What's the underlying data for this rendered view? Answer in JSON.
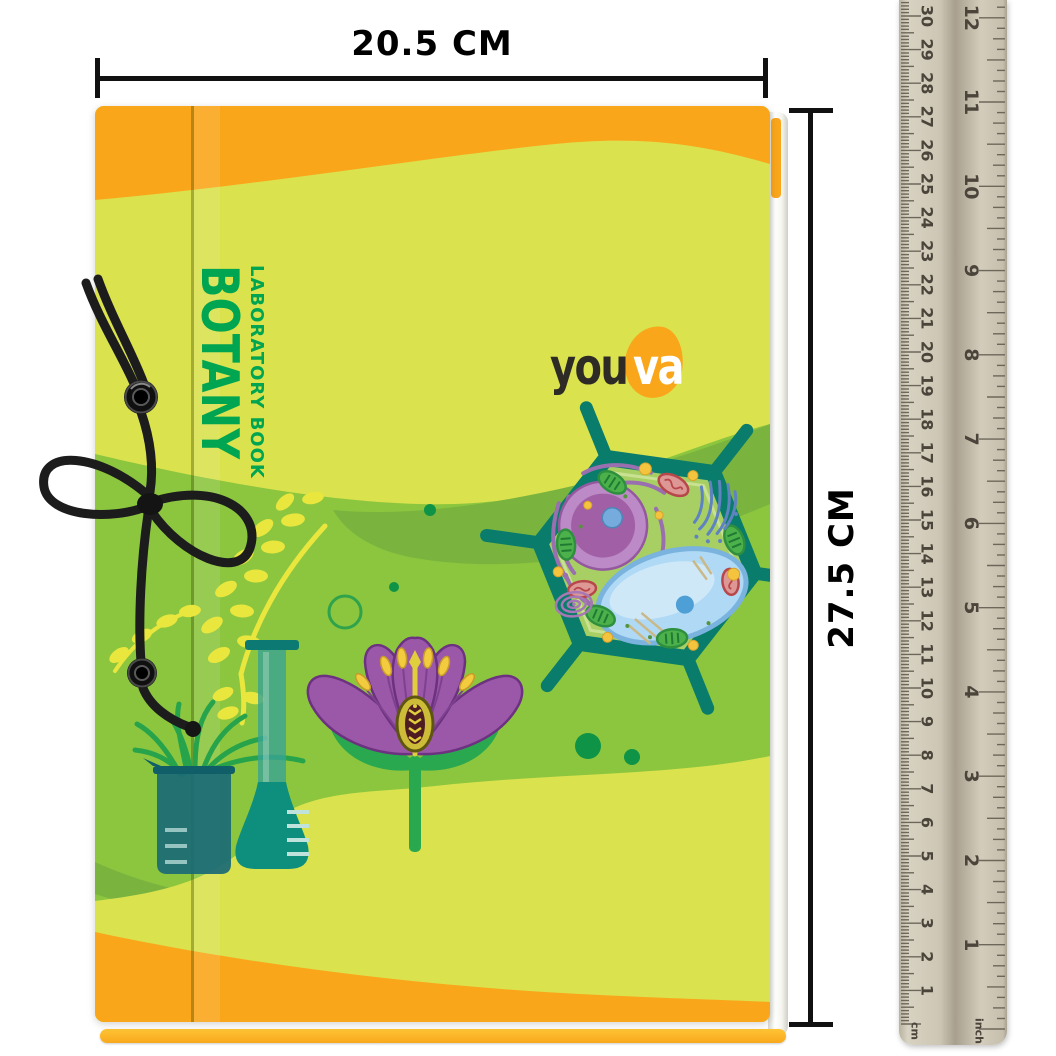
{
  "annotations": {
    "width_label": "20.5 CM",
    "height_label": "27.5 CM"
  },
  "book": {
    "title": "BOTANY",
    "subtitle": "LABORATORY BOOK",
    "brand": {
      "text_dark": "you",
      "text_light": "va"
    }
  },
  "ruler": {
    "cm_numbers": [
      1,
      2,
      3,
      4,
      5,
      6,
      7,
      8,
      9,
      10,
      11,
      12,
      13,
      14,
      15,
      16,
      17,
      18,
      19,
      20,
      21,
      22,
      23,
      24,
      25,
      26,
      27,
      28,
      29,
      30
    ],
    "inch_numbers": [
      1,
      2,
      3,
      4,
      5,
      6,
      7,
      8,
      9,
      10,
      11,
      12
    ],
    "cm_unit_label": "cm",
    "inch_unit_label": "inch"
  },
  "colors": {
    "orange": "#FAA61B",
    "yellow_green": "#DAE24E",
    "mid_green": "#8CC63E",
    "dark_green_swoosh": "#7AB43F",
    "title_green": "#00A551",
    "teal": "#0A7C6B",
    "purple": "#9B57A8",
    "cord_black": "#1C1C1C",
    "ruler_tan": "#CDC6B4",
    "annotation_black": "#111111"
  }
}
